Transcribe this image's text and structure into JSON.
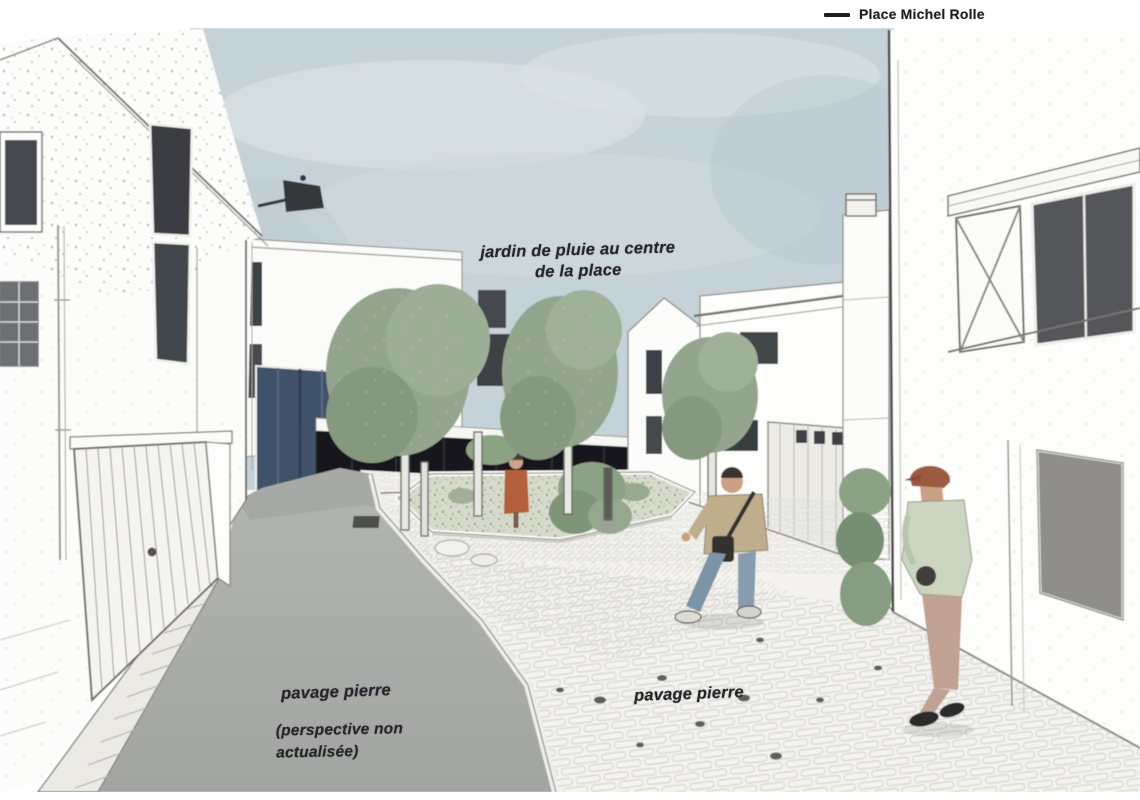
{
  "legend": {
    "items": [
      {
        "label": "Place Michel Rolle"
      }
    ]
  },
  "annotations": {
    "rain_garden": "jardin de pluie au centre de la place",
    "paving_left": "pavage pierre",
    "paving_left_note": "(perspective non actualisée)",
    "paving_right": "pavage pierre"
  },
  "colors": {
    "sky": "#c5d2d8",
    "tree_green": "#93a58c",
    "asphalt": "#a8aba7",
    "stone_paving": "#f4f3ef",
    "glass_blue": "#41516b",
    "annotation_ink": "#26262a"
  }
}
